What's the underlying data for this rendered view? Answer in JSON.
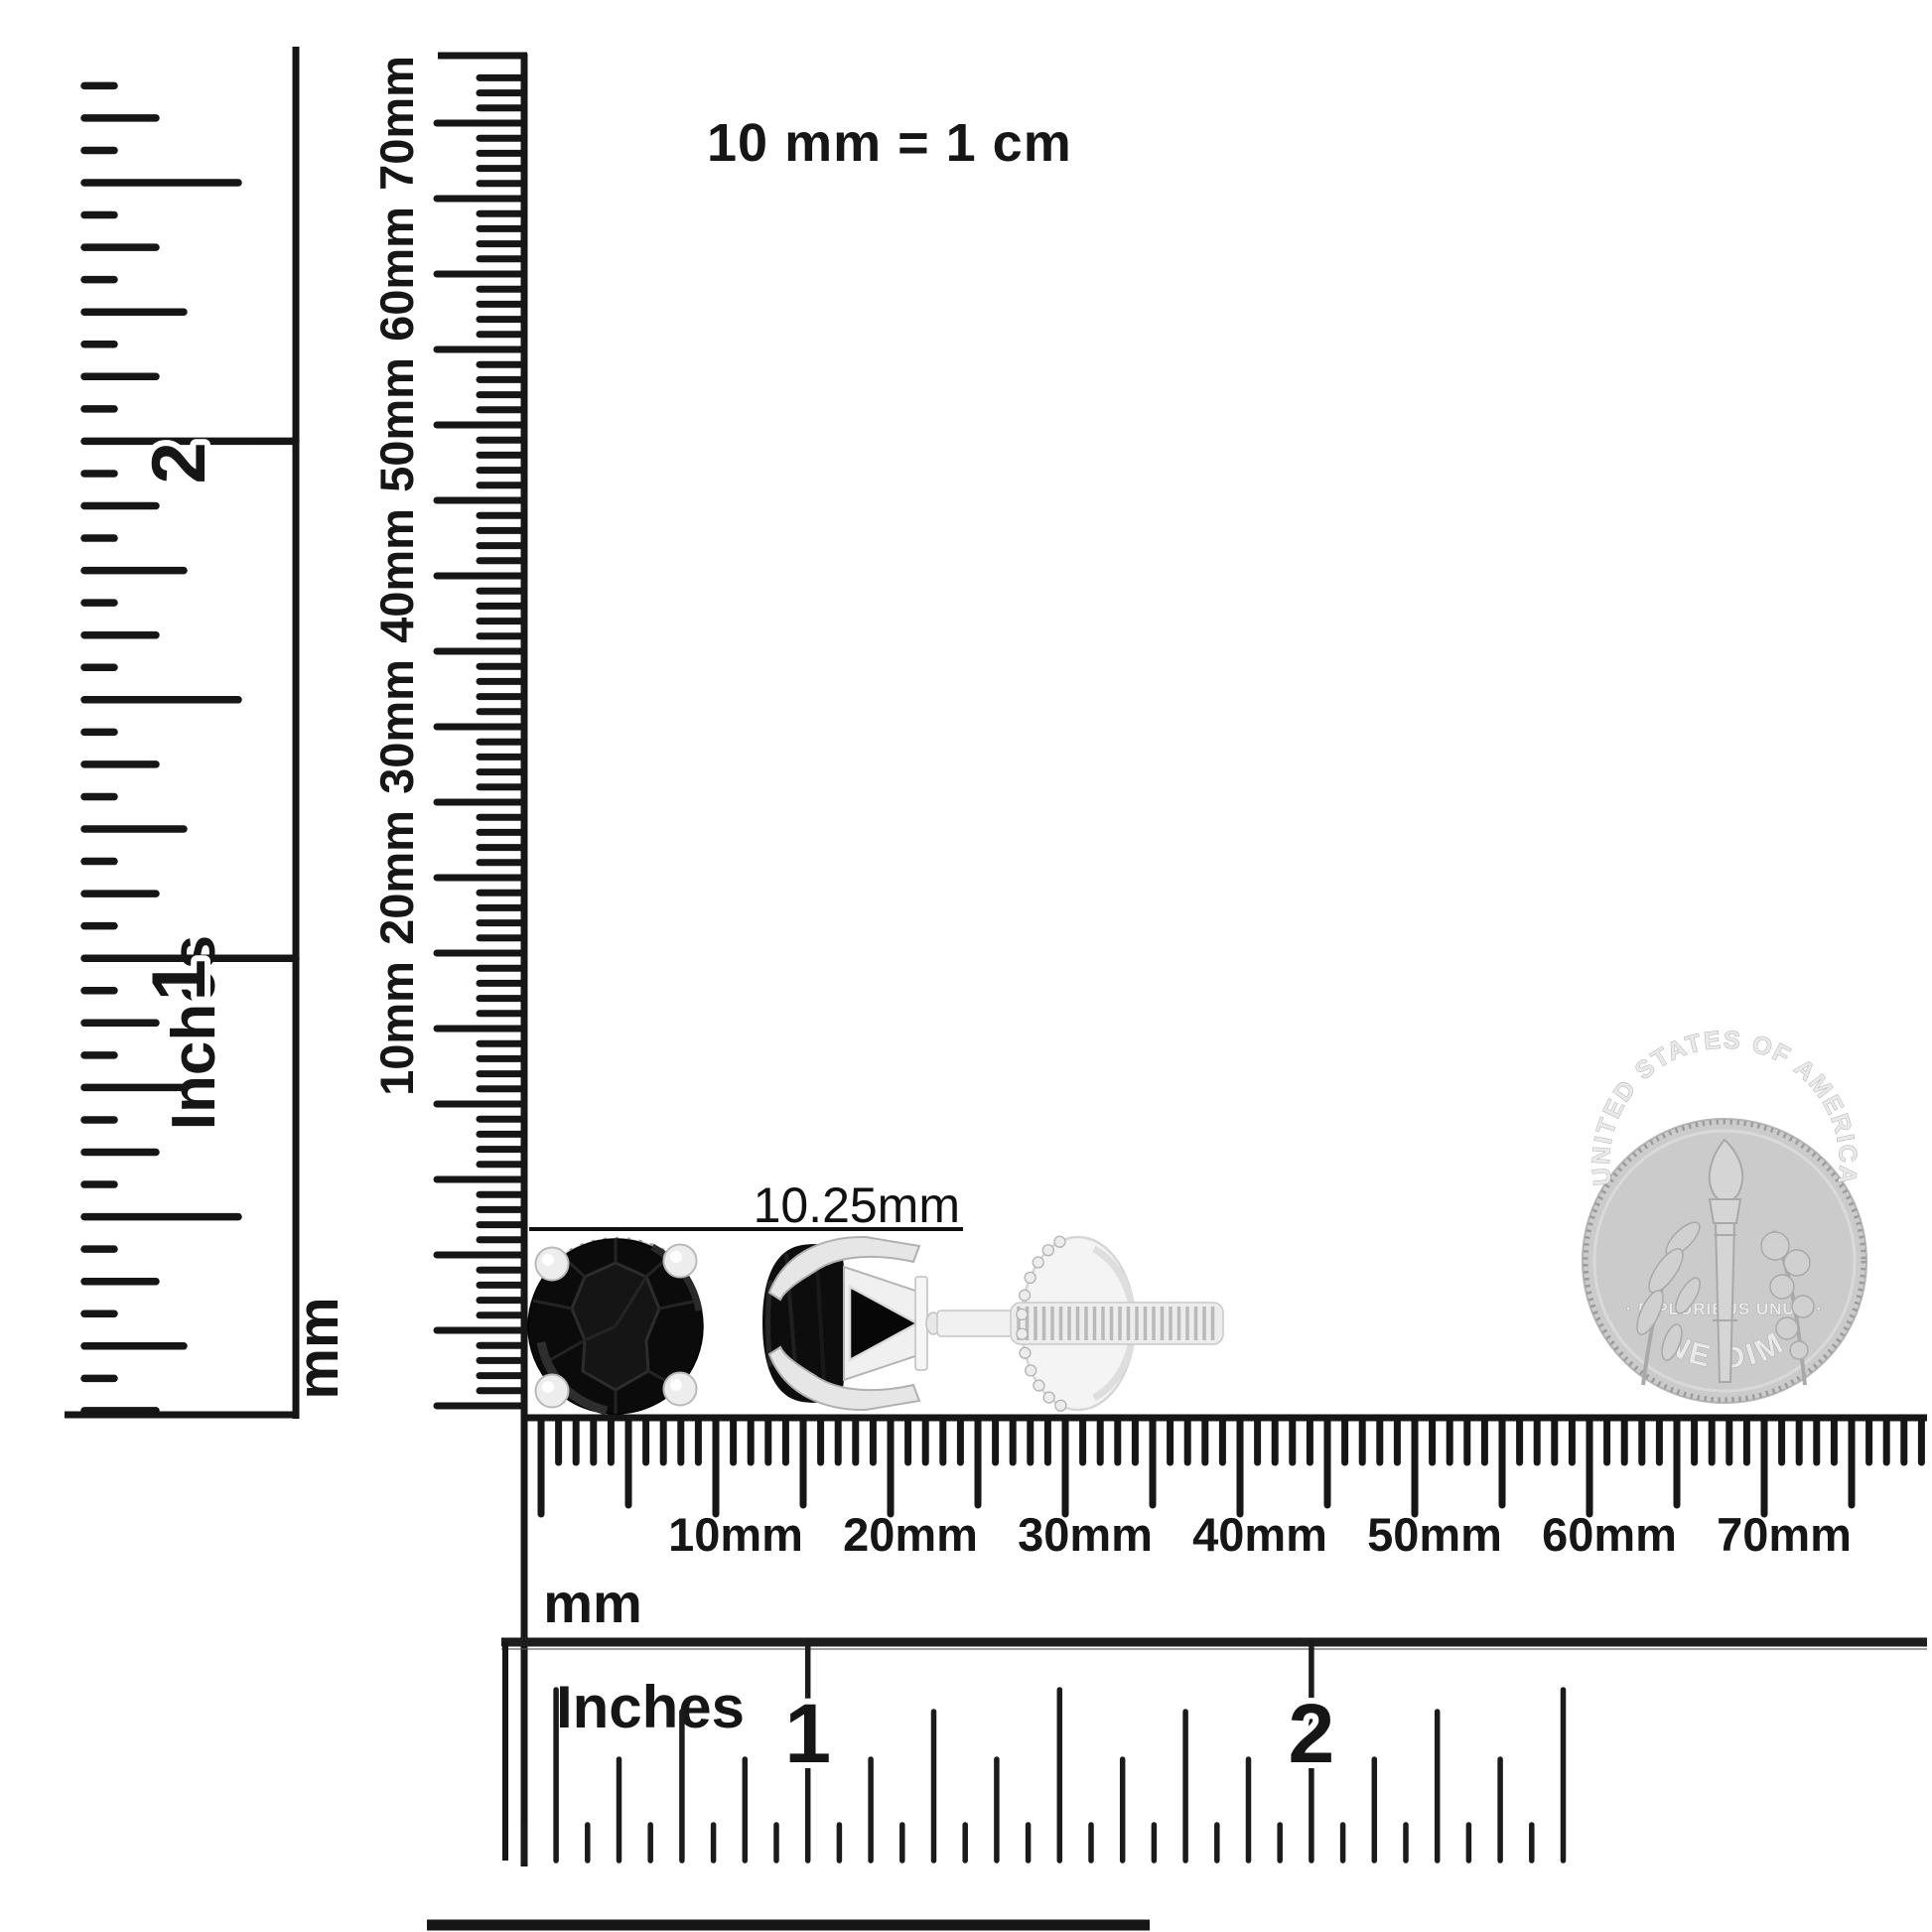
{
  "header": {
    "scale_note": "10 mm = 1 cm"
  },
  "annotation": {
    "measurement": "10.25mm"
  },
  "left_inch_ruler": {
    "unit_label": "Inches",
    "numbers": [
      "1",
      "2"
    ]
  },
  "vertical_mm_ruler": {
    "unit_label": "mm",
    "labels": [
      "10mm",
      "20mm",
      "30mm",
      "40mm",
      "50mm",
      "60mm",
      "70mm"
    ]
  },
  "bottom_mm_ruler": {
    "unit_label": "mm",
    "labels": [
      "10mm",
      "20mm",
      "30mm",
      "40mm",
      "50mm",
      "60mm",
      "70mm"
    ]
  },
  "bottom_inch_ruler": {
    "unit_label": "Inches",
    "numbers": [
      "1",
      "2"
    ]
  },
  "coin": {
    "top_text": "UNITED STATES OF AMERICA",
    "middle_text": "· E PLURIBUS UNUM ·",
    "bottom_text": "ONE DIME"
  },
  "colors": {
    "ink": "#161616",
    "stone_black": "#0b0b0b",
    "silver_light": "#f2f2f2",
    "silver_mid": "#d8d8d8",
    "silver_dark": "#a8a8a8",
    "coin_face": "#cbcbcb",
    "coin_text": "#e9e9e9"
  }
}
